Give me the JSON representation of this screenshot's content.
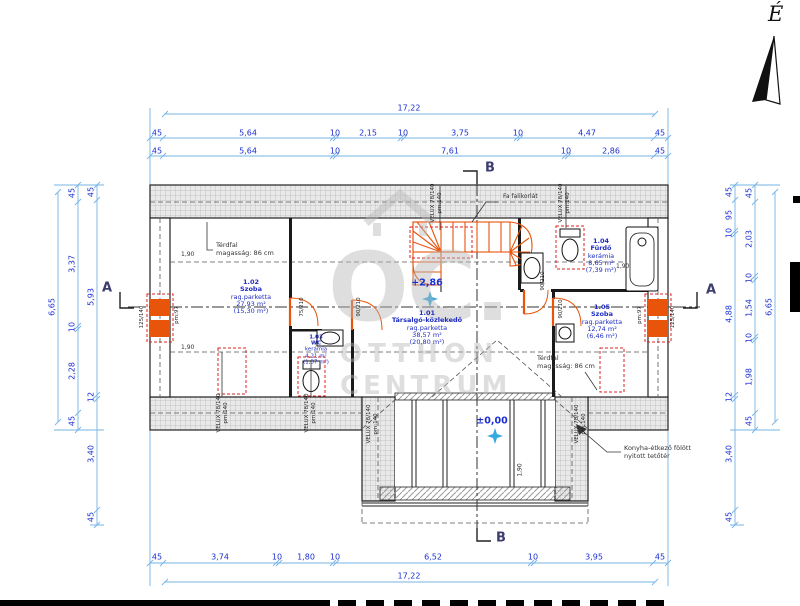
{
  "palette": {
    "dim_line": "#76b4e6",
    "dim_text": "#1b2fd0",
    "room_text": "#1f2dc0",
    "stairs_orange": "#e8540a",
    "red_dash": "#dd2222",
    "wall": "#222222",
    "watermark": "#b8b8b8"
  },
  "compass": {
    "north": "É"
  },
  "sections": {
    "a": "A",
    "b": "B"
  },
  "levels": {
    "upper": "+2,86",
    "ground": "±0,00"
  },
  "dims": {
    "top_total": "17,22",
    "top1": [
      "45",
      "5,64",
      "10",
      "2,15",
      "10",
      "3,75",
      "10",
      "4,47",
      "45"
    ],
    "top2": [
      "45",
      "5,64",
      "10",
      "7,61",
      "10",
      "2,86",
      "45"
    ],
    "bottom1": [
      "45",
      "3,74",
      "10",
      "1,80",
      "10",
      "6,52",
      "10",
      "3,95",
      "45"
    ],
    "bottom_total": "17,22",
    "left_outer": "6,65",
    "left_mid": [
      "45",
      "3,37",
      "10",
      "2,28",
      "45"
    ],
    "left_inner": [
      "45",
      "5,93",
      "12",
      "3,40",
      "45"
    ],
    "right_inner": [
      "45",
      "95",
      "10",
      "4,88",
      "12",
      "3,40",
      "45"
    ],
    "right_mid": [
      "45",
      "2,03",
      "10",
      "1,54",
      "10",
      "1,98",
      "45"
    ],
    "right_outer": "6,65"
  },
  "rooms": [
    {
      "id": "1.02",
      "name": "Szoba",
      "finish": "rag.parketta",
      "area": "27,93 m²",
      "area_reduced": "(15,30 m²)"
    },
    {
      "id": "1.01",
      "name": "Társalgó-közlekedő",
      "finish": "rag.parketta",
      "area": "38,57 m²",
      "area_reduced": "(20,80 m²)"
    },
    {
      "id": "1.03",
      "name": "WC",
      "finish": "kerámia",
      "area": "4,21 m²",
      "area_reduced": "(1,37 m²)"
    },
    {
      "id": "1.04",
      "name": "Fürdő",
      "finish": "kerámia",
      "area": "8,65 m²",
      "area_reduced": "(7,39 m²)"
    },
    {
      "id": "1.05",
      "name": "Szoba",
      "finish": "rag.parketta",
      "area": "12,74 m²",
      "area_reduced": "(6,46 m²)"
    }
  ],
  "annotations": {
    "kneewall1": "Térdfal",
    "kneewall2": "magasság: 86 cm",
    "railing": "Fa falikorlát",
    "open_roof1": "Konyha-étkező fölött",
    "open_roof2": "nyitott tetőtér",
    "headroom": "1,90",
    "velux": "VELUX 78/140",
    "velux_pm": "pm:140",
    "window": "125/140",
    "window_pm": "pm:97",
    "door_90": "90/210",
    "door_75": "75/210",
    "tub": "1,90"
  },
  "watermark": {
    "logo": "OC.",
    "line1": "OTTHON",
    "line2": "CENTRUM"
  }
}
